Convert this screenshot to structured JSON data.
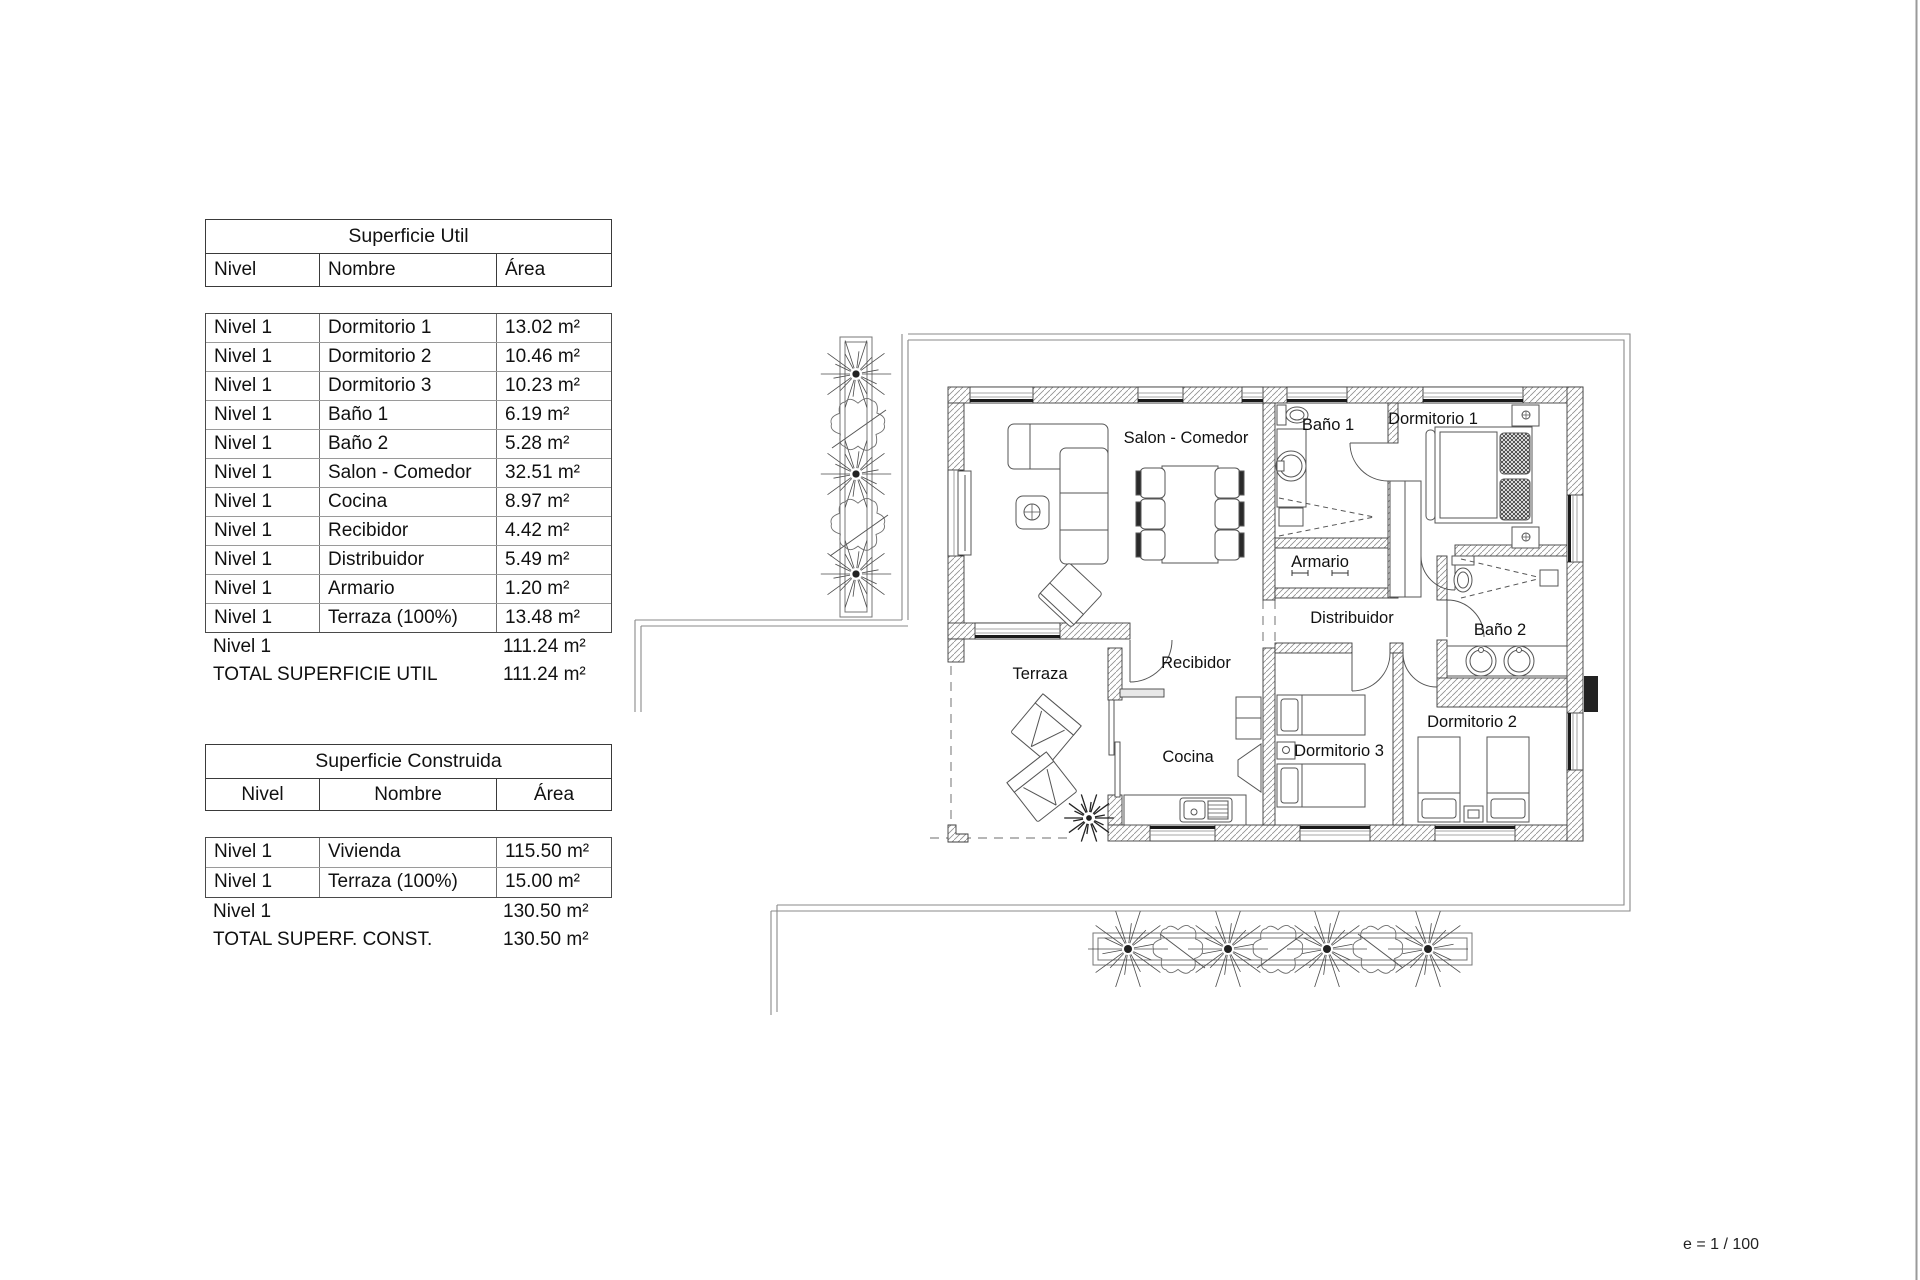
{
  "page": {
    "scale_note": "e = 1 / 100"
  },
  "tables": {
    "util": {
      "title": "Superficie Util",
      "headers": [
        "Nivel",
        "Nombre",
        "Área"
      ],
      "rows": [
        [
          "Nivel 1",
          "Dormitorio 1",
          "13.02 m²"
        ],
        [
          "Nivel 1",
          "Dormitorio 2",
          "10.46 m²"
        ],
        [
          "Nivel 1",
          "Dormitorio 3",
          "10.23 m²"
        ],
        [
          "Nivel 1",
          "Baño 1",
          "6.19 m²"
        ],
        [
          "Nivel 1",
          "Baño 2",
          "5.28 m²"
        ],
        [
          "Nivel 1",
          "Salon - Comedor",
          "32.51 m²"
        ],
        [
          "Nivel 1",
          "Cocina",
          "8.97 m²"
        ],
        [
          "Nivel 1",
          "Recibidor",
          "4.42 m²"
        ],
        [
          "Nivel 1",
          "Distribuidor",
          "5.49 m²"
        ],
        [
          "Nivel 1",
          "Armario",
          "1.20 m²"
        ],
        [
          "Nivel 1",
          "Terraza (100%)",
          "13.48 m²"
        ]
      ],
      "subtotal_level": "Nivel 1",
      "subtotal_area": "111.24 m²",
      "total_label": "TOTAL SUPERFICIE UTIL",
      "total_area": "111.24 m²"
    },
    "construida": {
      "title": "Superficie Construida",
      "headers": [
        "Nivel",
        "Nombre",
        "Área"
      ],
      "rows": [
        [
          "Nivel 1",
          "Vivienda",
          "115.50 m²"
        ],
        [
          "Nivel 1",
          "Terraza (100%)",
          "15.00 m²"
        ]
      ],
      "subtotal_level": "Nivel 1",
      "subtotal_area": "130.50 m²",
      "total_label": "TOTAL SUPERF. CONST.",
      "total_area": "130.50 m²"
    }
  },
  "floorplan": {
    "rooms": [
      {
        "label": "Salon - Comedor"
      },
      {
        "label": "Baño 1"
      },
      {
        "label": "Dormitorio 1"
      },
      {
        "label": "Armario"
      },
      {
        "label": "Distribuidor"
      },
      {
        "label": "Baño 2"
      },
      {
        "label": "Terraza"
      },
      {
        "label": "Recibidor"
      },
      {
        "label": "Cocina"
      },
      {
        "label": "Dormitorio 3"
      },
      {
        "label": "Dormitorio 2"
      }
    ]
  }
}
